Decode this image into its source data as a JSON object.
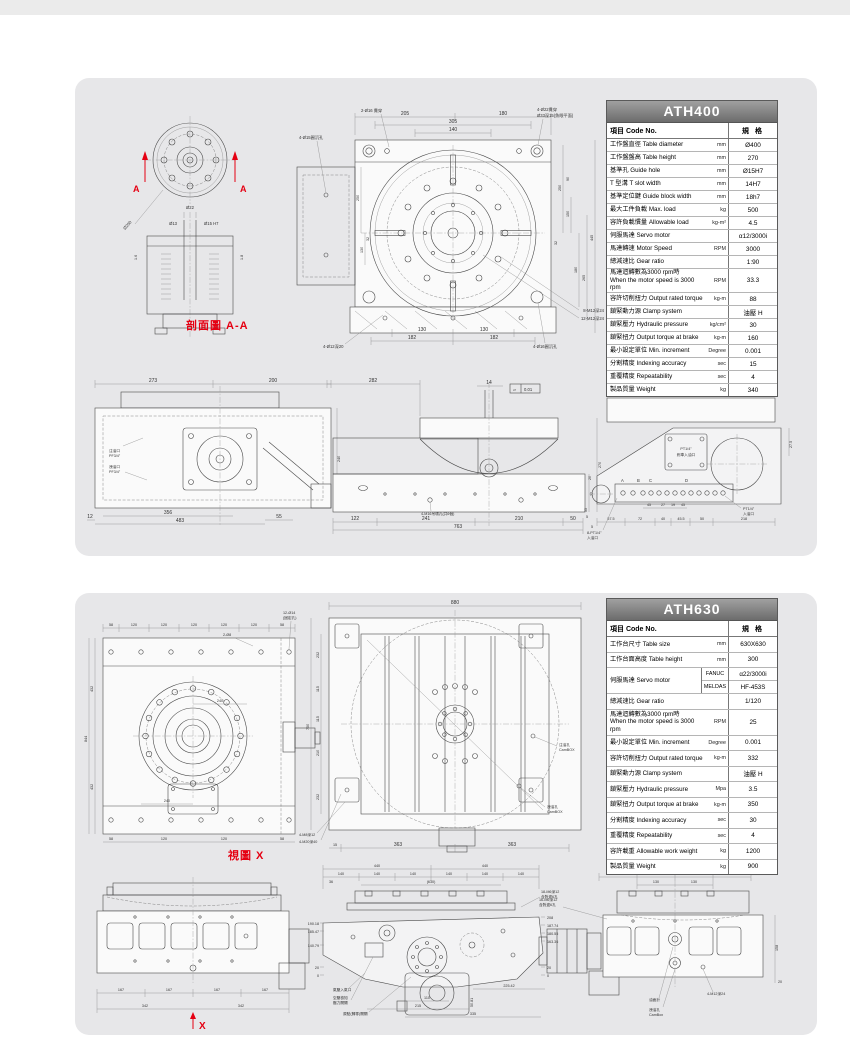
{
  "page": {
    "accent_red": "#e50012",
    "panel_bg": "#e7e7e9",
    "header_gray": "#6c6c6c"
  },
  "ath400": {
    "title": "ATH400",
    "col_item": "項目 Code No.",
    "col_spec": "規 格",
    "rows": [
      {
        "zh": "工作盤直徑",
        "en": "Table diameter",
        "unit": "mm",
        "value": "Ø400"
      },
      {
        "zh": "工作盤盤高",
        "en": "Table height",
        "unit": "mm",
        "value": "270"
      },
      {
        "zh": "基準孔",
        "en": "Guide hole",
        "unit": "mm",
        "value": "Ø15H7"
      },
      {
        "zh": "T 型溝",
        "en": "T slot width",
        "unit": "mm",
        "value": "14H7"
      },
      {
        "zh": "基準定位鍵",
        "en": "Guide block width",
        "unit": "mm",
        "value": "18h7"
      },
      {
        "zh": "最大工件負載",
        "en": "Max. load",
        "unit": "kg",
        "value": "500"
      },
      {
        "zh": "容許負載慣量",
        "en": "Allowable load",
        "unit": "kg-m²",
        "value": "4.5"
      },
      {
        "zh": "伺服馬達",
        "en": "Servo motor",
        "unit": "",
        "value": "α12/3000i"
      },
      {
        "zh": "馬達轉速",
        "en": "Motor Speed",
        "unit": "RPM",
        "value": "3000"
      },
      {
        "zh": "總減速比",
        "en": "Gear ratio",
        "unit": "",
        "value": "1:90"
      },
      {
        "zh": "馬達迴轉數為3000 rpm時",
        "en": "When the motor speed is 3000 rpm",
        "unit": "RPM",
        "value": "33.3",
        "tall": true
      },
      {
        "zh": "容許切削扭力",
        "en": "Output rated torque",
        "unit": "kg-m",
        "value": "88"
      },
      {
        "zh": "鎖緊動力源",
        "en": "Clamp system",
        "unit": "",
        "value": "油壓 H"
      },
      {
        "zh": "鎖緊壓力",
        "en": "Hydraulic pressure",
        "unit": "kg/cm²",
        "value": "30"
      },
      {
        "zh": "鎖緊扭力",
        "en": "Output torque at brake",
        "unit": "kg-m",
        "value": "160"
      },
      {
        "zh": "最小設定單位",
        "en": "Min. increment",
        "unit": "Degree",
        "value": "0.001"
      },
      {
        "zh": "分割精度",
        "en": "Indexing accuracy",
        "unit": "sec",
        "value": "15"
      },
      {
        "zh": "重覆精度",
        "en": "Repeatability",
        "unit": "sec",
        "value": "4"
      },
      {
        "zh": "製品質量",
        "en": "Weight",
        "unit": "kg",
        "value": "340"
      }
    ],
    "section": {
      "label": "剖面圖 A-A",
      "a": "A",
      "dia_tag": "Ø200",
      "d22": "Ø22",
      "d13": "Ø13",
      "d15": "Ø15 H7",
      "t16": "1.6",
      "t18": "1.8"
    },
    "main": {
      "dims_top": [
        "205",
        "180",
        "305",
        "140"
      ],
      "callout_tl": "2-Ø16 貫穿",
      "callout_tl2": "4-Ø15圓沉孔",
      "callout_tr": "4-Ø22貫穿",
      "callout_tr2": "Ø33深15(魚眼平面)",
      "dims_left": [
        "250",
        "130",
        "32"
      ],
      "dims_right": [
        "250",
        "150",
        "90",
        "32",
        "180",
        "265",
        "445"
      ],
      "dims_bottom": [
        "130",
        "130",
        "182",
        "182"
      ],
      "callout_b1": "4-Ø12深20",
      "callout_b2": "4-Ø16圓沉孔",
      "callout_r1": "8-M12深24",
      "callout_r2": "12-M12深24"
    },
    "rear": {
      "d273": "273",
      "d200": "200",
      "d240": "240",
      "d12": "12",
      "d356": "356",
      "d483": "483",
      "d55": "55",
      "oil_in_a": "注油口",
      "oil_in_b": "PF3/4\"",
      "oil_out_a": "洩油口",
      "oil_out_b": "PF3/4\""
    },
    "side": {
      "d282": "282",
      "d14": "14",
      "flat": "0.01",
      "d122": "122",
      "d241": "241",
      "d210": "210",
      "d50": "50",
      "d763": "763",
      "d270": "270",
      "d77": "77",
      "d5": "5",
      "lift": "4-M16吊環孔(共6個)"
    },
    "end": {
      "dia": "Ø400",
      "dims": [
        "57.5",
        "72",
        "40",
        "45.5",
        "50",
        "218"
      ],
      "dims2": [
        "45",
        "27",
        "19",
        "45"
      ],
      "d275": "27.5",
      "d20": "20",
      "d55": "55",
      "d5": "5",
      "ports": [
        "A",
        "B",
        "C",
        "D"
      ],
      "brake_a": "PT1/4\"",
      "brake_b": "剎車入油口",
      "inlet8_a": "8-PT1/4\"",
      "inlet8_b": "入油口",
      "inlet_a": "PT1/4\"",
      "inlet_b": "入油口"
    }
  },
  "ath630": {
    "title": "ATH630",
    "col_item": "項目 Code No.",
    "col_spec": "規 格",
    "rows": [
      {
        "zh": "工作台尺寸",
        "en": "Table size",
        "unit": "mm",
        "value": "630X630"
      },
      {
        "zh": "工作台面高度",
        "en": "Table height",
        "unit": "mm",
        "value": "300"
      },
      {
        "type": "motor",
        "zh": "伺服馬達",
        "en": "Servo motor",
        "subs": [
          {
            "label": "FANUC",
            "value": "α22/3000i"
          },
          {
            "label": "MELDAS",
            "value": "HF-453S"
          }
        ]
      },
      {
        "zh": "總減速比",
        "en": "Gear ratio",
        "unit": "",
        "value": "1/120"
      },
      {
        "zh": "馬達迴轉數為3000 rpm時",
        "en": "When the motor speed is 3000 rpm",
        "unit": "RPM",
        "value": "25",
        "tall": true
      },
      {
        "zh": "最小設定單位",
        "en": "Min. increment",
        "unit": "Degree",
        "value": "0.001"
      },
      {
        "zh": "容許切削扭力",
        "en": "Output rated torque",
        "unit": "kg-m",
        "value": "332"
      },
      {
        "zh": "鎖緊動力源",
        "en": "Clamp system",
        "unit": "",
        "value": "油壓 H"
      },
      {
        "zh": "鎖緊壓力",
        "en": "Hydraulic pressure",
        "unit": "Mpa",
        "value": "3.5"
      },
      {
        "zh": "鎖緊扭力",
        "en": "Output torque at brake",
        "unit": "kg-m",
        "value": "350"
      },
      {
        "zh": "分割精度",
        "en": "Indexing accuracy",
        "unit": "sec",
        "value": "30"
      },
      {
        "zh": "重覆精度",
        "en": "Repeatability",
        "unit": "sec",
        "value": "4"
      },
      {
        "zh": "容許載重",
        "en": "Allowable work weight",
        "unit": "kg",
        "value": "1200"
      },
      {
        "zh": "製品質量",
        "en": "Weight",
        "unit": "kg",
        "value": "900"
      }
    ],
    "viewx": {
      "label": "視圖 X",
      "t58": "58",
      "t120": "120",
      "l432": "432",
      "l844": "844",
      "d240": "240",
      "c1a": "12-Ø14",
      "c1b": "(固定孔)",
      "c2": "2-Ø8"
    },
    "top": {
      "d880": "880",
      "d750": "750",
      "left": [
        "232",
        "115",
        "115",
        "210",
        "232"
      ],
      "d363": "363",
      "d15": "15",
      "c1": "4-M8深12",
      "c2": "4-M20深40",
      "c3a": "注油孔",
      "c3b": "CamBOX",
      "c4a": "洩油孔",
      "c4b": "CamBOX"
    },
    "front": {
      "d167": "167",
      "d342": "342",
      "x": "X"
    },
    "side": {
      "d440": "440",
      "d140": "140",
      "d630": "(630)",
      "d36": "36",
      "lh": [
        "190.18",
        "185.47",
        "140.79",
        "20",
        "0"
      ],
      "rh": [
        "208",
        "187.74",
        "180.55",
        "163.36",
        "20",
        "0"
      ],
      "b110": "110",
      "b215": "215",
      "b225": "225.42",
      "b335": "335",
      "b50": "50.81",
      "c1a": "18-M6深12",
      "c1b": "含對邊6孔",
      "c2": "氣壓入氣口",
      "c3a": "空壓檢知",
      "c3b": "壓力開關",
      "c4": "原點(歸零)開關"
    },
    "rear": {
      "d167": "167",
      "d130": "130",
      "d158": "158",
      "d20": "20",
      "c1a": "16-M6深12",
      "c1b": "含對邊6孔",
      "c2": "油面計",
      "c3a": "洩油孔",
      "c3b": "CamBox",
      "c4": "4-M12深24"
    }
  }
}
